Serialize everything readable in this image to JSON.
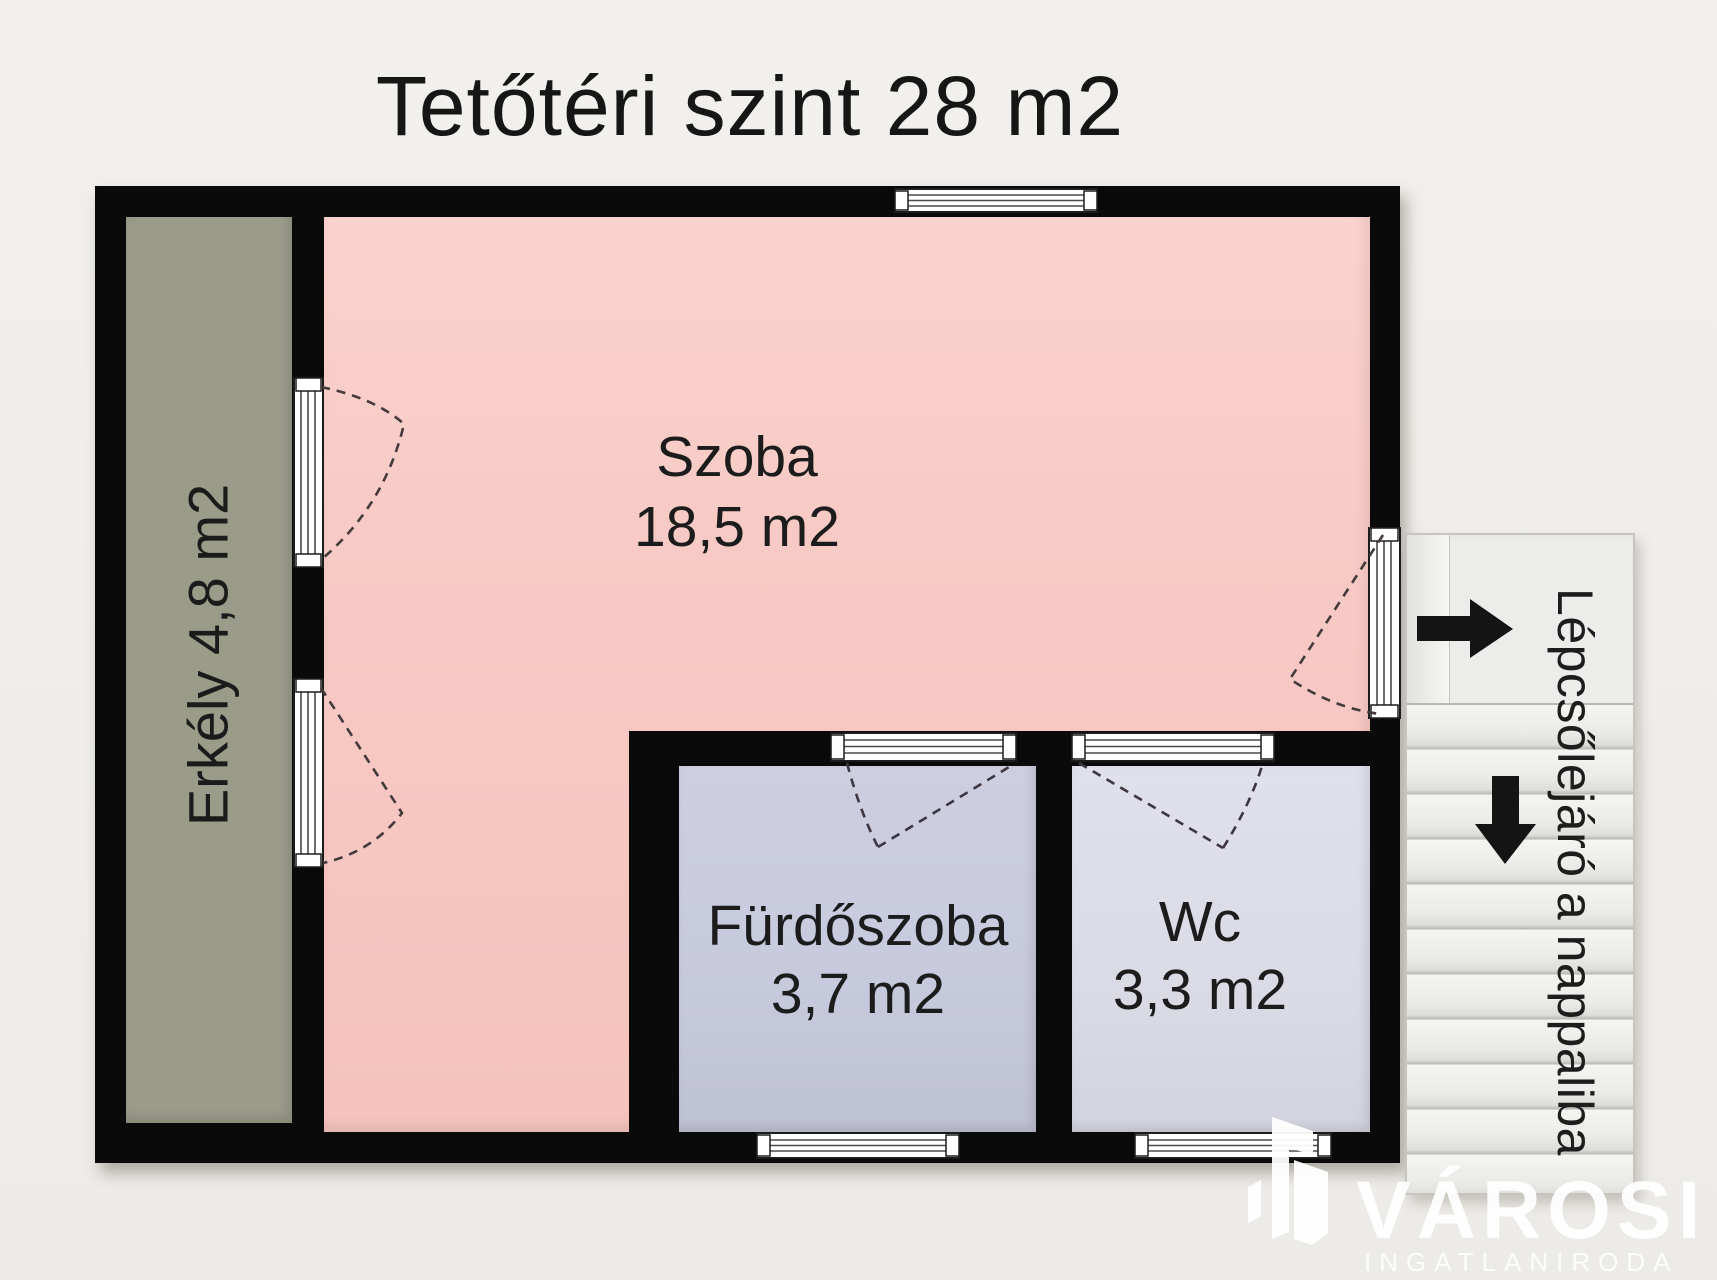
{
  "title": "Tetőtéri szint 28 m2",
  "rooms": {
    "szoba": {
      "name": "Szoba",
      "area": "18,5 m2"
    },
    "erkely": {
      "label": "Erkély 4,8 m2"
    },
    "furdoszoba": {
      "name": "Fürdőszoba",
      "area": "3,7 m2"
    },
    "wc": {
      "name": "Wc",
      "area": "3,3 m2"
    }
  },
  "stairs": {
    "label": "Lépcsőlejáró a nappaliba"
  },
  "watermark": {
    "brand": "VÁROSI",
    "subtitle": "INGATLANIRODA"
  },
  "icons": {
    "stair_entry": "arrow-right-icon",
    "stair_down": "arrow-down-icon",
    "logo": "buildings-logo-icon"
  },
  "colors": {
    "bg": "#f2f0ec",
    "wall": "#0a0a0a",
    "szoba": "#f8cac5",
    "erkely": "#9b9b8a",
    "furdoszoba": "#c7c9dc",
    "wc": "#dadbe5",
    "stairs": "#ececea",
    "arrow": "#141414",
    "watermark": "#ffffff"
  }
}
